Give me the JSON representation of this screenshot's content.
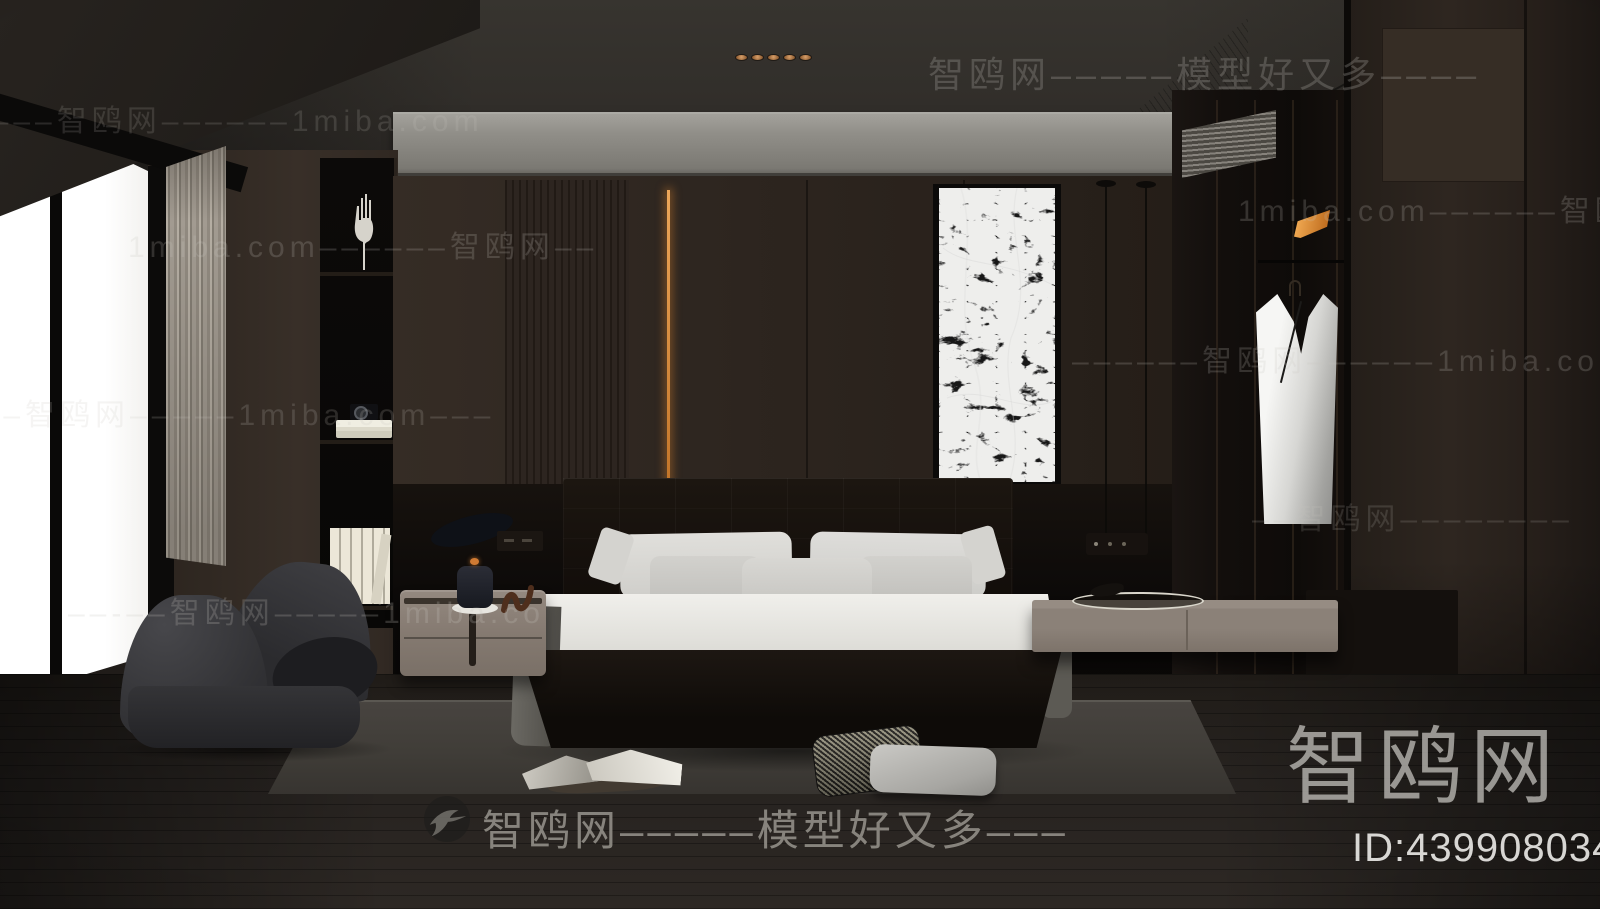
{
  "scene": {
    "description": "3D rendered modern dark bedroom interior with bed, nightstands, armchair, wardrobe and marble wall panel",
    "colors": {
      "wall_brown": "#2d2520",
      "accent_led_orange": "#d98a3f",
      "cove_grey": "#8b8984",
      "bedding_white": "#e9e8e4",
      "blanket_grey": "#6e6c66",
      "nightstand_taupe": "#8a7f76",
      "rug_grey": "#403d38",
      "floor_dark": "#221e1a",
      "lamp_glow_orange": "#e8a14d",
      "window_light": "#ffffff"
    }
  },
  "watermarks": {
    "brand": "智鸥网",
    "site": "1miba.com",
    "slogan": "模型好又多",
    "rows": [
      {
        "text": "智鸥网–––––模型好又多––––"
      },
      {
        "text": "––––智鸥网––––––1miba.com"
      },
      {
        "text": "1miba.com––––––智鸥网––"
      },
      {
        "text": "1miba.com––––––智鸥网––"
      },
      {
        "text": "––––––智鸥网––––––1miba.com"
      },
      {
        "text": "–––智鸥网–––––1miba.com–––"
      },
      {
        "text": "––智鸥网––––––––"
      },
      {
        "text": "––-––智鸥网–––––1miba.co"
      }
    ],
    "bottom_bar_text": "智鸥网–––––模型好又多–––",
    "brand_large": "智鸥网",
    "id_label": "ID:439908034",
    "logo_icon": "swallow-bird-icon"
  }
}
